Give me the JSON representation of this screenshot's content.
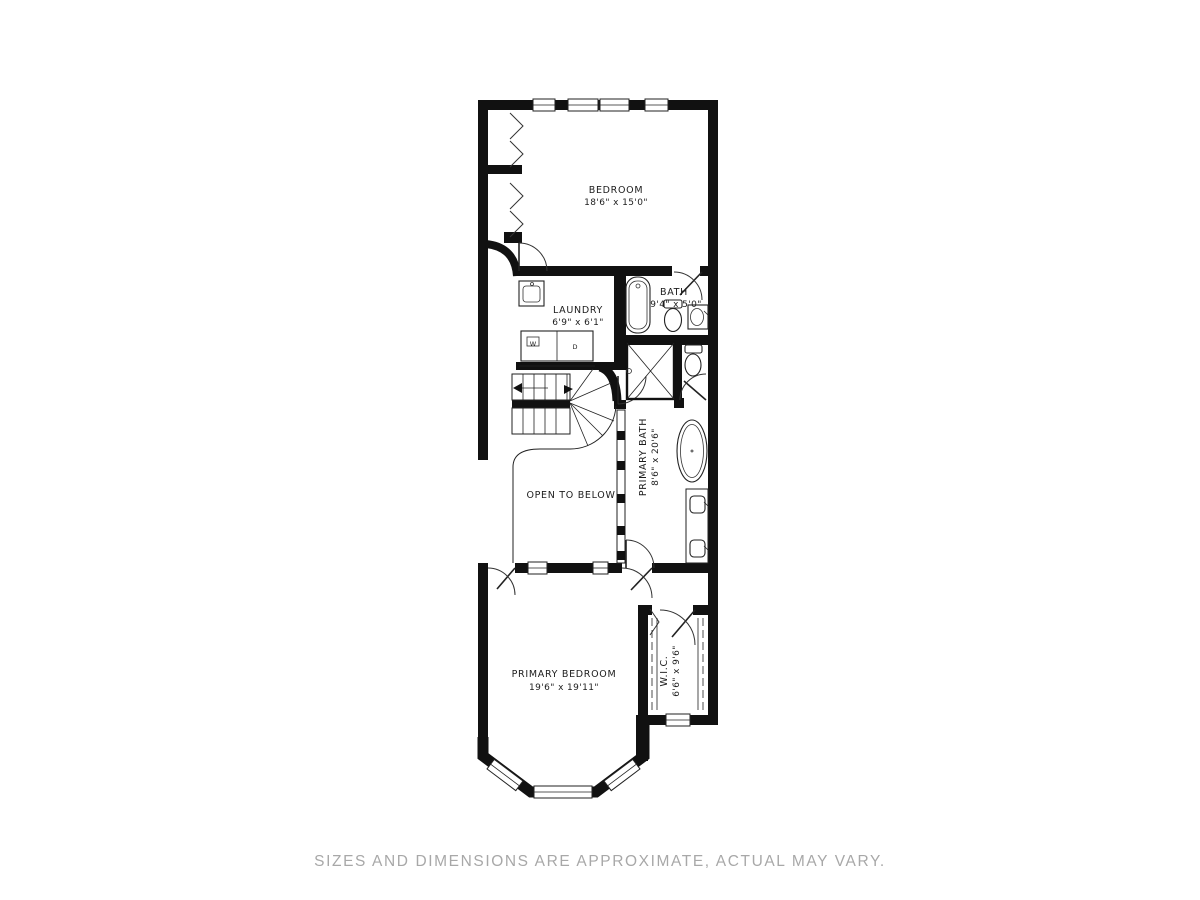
{
  "disclaimer": "SIZES AND DIMENSIONS ARE APPROXIMATE, ACTUAL MAY VARY.",
  "rooms": {
    "bedroom": {
      "name": "BEDROOM",
      "dims": "18'6\" x 15'0\""
    },
    "laundry": {
      "name": "LAUNDRY",
      "dims": "6'9\" x 6'1\""
    },
    "bath": {
      "name": "BATH",
      "dims": "9'4\" x 5'0\""
    },
    "primary_bath": {
      "name": "PRIMARY BATH",
      "dims": "8'6\" x 20'6\""
    },
    "open_to_below": {
      "name": "OPEN TO BELOW"
    },
    "primary_bedroom": {
      "name": "PRIMARY BEDROOM",
      "dims": "19'6\" x 19'11\""
    },
    "wic": {
      "name": "W.I.C.",
      "dims": "6'6\" x 9'6\""
    }
  },
  "fixtures": {
    "washer_label": "W",
    "dryer_label": "D"
  },
  "colors": {
    "wall": "#111111",
    "line": "#222222",
    "disclaimer_text": "#a8a8a8",
    "background": "#ffffff"
  }
}
